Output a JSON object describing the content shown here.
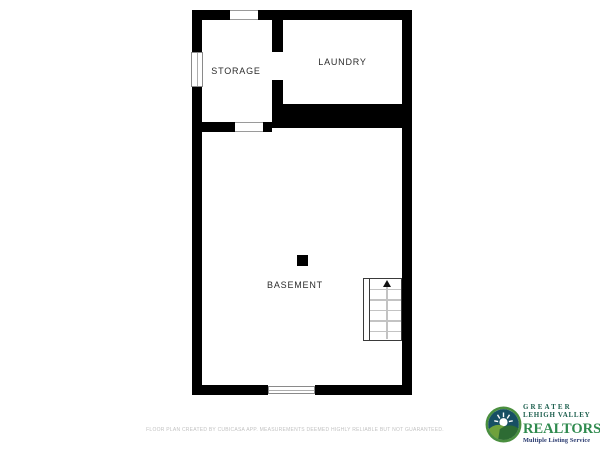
{
  "plan": {
    "rooms": {
      "storage": {
        "label": "STORAGE"
      },
      "laundry": {
        "label": "LAUNDRY"
      },
      "basement": {
        "label": "BASEMENT"
      }
    },
    "features": {
      "stairs": {
        "direction": "up",
        "steps": 6
      },
      "support_post": true,
      "windows": [
        "storage-left-wall",
        "basement-bottom-wall"
      ],
      "openings": [
        "storage-top-wall",
        "storage-to-laundry",
        "storage-to-basement"
      ]
    },
    "colors": {
      "wall": "#000000",
      "label_text": "#2b2b2b",
      "tread_gray": "#c3c3c3"
    }
  },
  "icons": {
    "stairs_arrow": "up-arrow-icon",
    "logo_icon": "sunrise-hills-logo-icon"
  },
  "footer": {
    "disclaimer": "FLOOR PLAN CREATED BY CUBICASA APP. MEASUREMENTS DEEMED HIGHLY RELIABLE BUT NOT GUARANTEED."
  },
  "logo": {
    "line1": "GREATER",
    "line2": "LEHIGH VALLEY",
    "line3": "REALTORS",
    "trademark": "®",
    "line4": "Multiple Listing Service",
    "colors": {
      "ring_green": "#4a8f3f",
      "sky_navy": "#174f63",
      "hill_light": "#6fa13c",
      "hill_dark": "#2d6b33",
      "text_dark_green": "#1d5f4e",
      "realtors_green": "#2f8a4e",
      "mls_navy": "#24356b"
    }
  }
}
